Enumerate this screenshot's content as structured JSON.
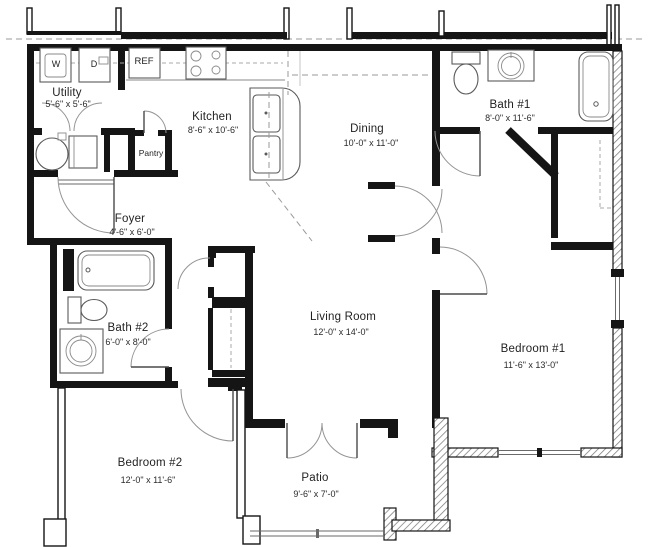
{
  "floorplan": {
    "rooms": {
      "utility": {
        "name": "Utility",
        "dims": "5'-6\" x 5'-6\""
      },
      "kitchen": {
        "name": "Kitchen",
        "dims": "8'-6\" x 10'-6\""
      },
      "dining": {
        "name": "Dining",
        "dims": "10'-0\" x 11'-0\""
      },
      "bath1": {
        "name": "Bath #1",
        "dims": "8'-0\" x 11'-6\""
      },
      "foyer": {
        "name": "Foyer",
        "dims": "4'-6\" x 6'-0\""
      },
      "pantry": {
        "name": "Pantry"
      },
      "bath2": {
        "name": "Bath #2",
        "dims": "6'-0\" x 8'-0\""
      },
      "living": {
        "name": "Living Room",
        "dims": "12'-0\" x 14'-0\""
      },
      "bedroom1": {
        "name": "Bedroom #1",
        "dims": "11'-6\" x 13'-0\""
      },
      "bedroom2": {
        "name": "Bedroom #2",
        "dims": "12'-0\" x 11'-6\""
      },
      "patio": {
        "name": "Patio",
        "dims": "9'-6\" x 7'-0\""
      }
    },
    "appliances": {
      "washer": "W",
      "dryer": "D",
      "refrigerator": "REF"
    },
    "colors": {
      "wall": "#151515",
      "fixture_stroke": "#5a5a5a",
      "dashed_line": "#9a9a9a",
      "background": "#ffffff",
      "text": "#1f1f1f"
    }
  }
}
